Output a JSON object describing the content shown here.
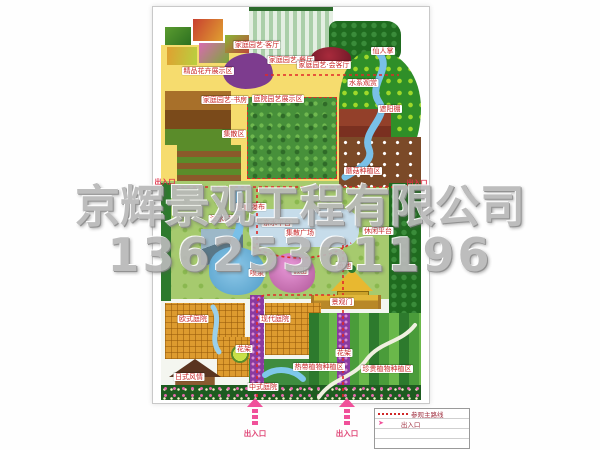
{
  "watermark": {
    "company": "京辉景观工程有限公司",
    "phone": "13625361196"
  },
  "colors": {
    "route_red": "#e02828",
    "entrance_pink": "#f0509a",
    "label_red": "#c82828",
    "watermark_gray": "#b9b9b9",
    "base_yellow": "#f6dc6e"
  },
  "map_labels": [
    {
      "text": "精品花卉展示区",
      "x": 55,
      "y": 64,
      "kind": "box"
    },
    {
      "text": "家庭园艺·客厅",
      "x": 104,
      "y": 38,
      "kind": "box"
    },
    {
      "text": "家庭园艺·餐厅",
      "x": 138,
      "y": 53,
      "kind": "box"
    },
    {
      "text": "家庭园艺·会客厅",
      "x": 171,
      "y": 58,
      "kind": "box"
    },
    {
      "text": "家庭园艺·书房",
      "x": 72,
      "y": 93,
      "kind": "box"
    },
    {
      "text": "庭院园艺展示区",
      "x": 125,
      "y": 92,
      "kind": "box"
    },
    {
      "text": "集散区",
      "x": 81,
      "y": 127,
      "kind": "box"
    },
    {
      "text": "仙人掌",
      "x": 230,
      "y": 44,
      "kind": "box"
    },
    {
      "text": "水系观赏",
      "x": 210,
      "y": 76,
      "kind": "box"
    },
    {
      "text": "遮阳棚",
      "x": 237,
      "y": 102,
      "kind": "box"
    },
    {
      "text": "蘑菇种植区",
      "x": 210,
      "y": 164,
      "kind": "box"
    },
    {
      "text": "出入口",
      "x": 12,
      "y": 175,
      "kind": "plain"
    },
    {
      "text": "出入口",
      "x": 264,
      "y": 176,
      "kind": "plain"
    },
    {
      "text": "滨水栈道",
      "x": 71,
      "y": 212,
      "kind": "box"
    },
    {
      "text": "假山瀑布",
      "x": 98,
      "y": 200,
      "kind": "box"
    },
    {
      "text": "亲水平台",
      "x": 124,
      "y": 216,
      "kind": "box"
    },
    {
      "text": "集散广场",
      "x": 147,
      "y": 226,
      "kind": "box"
    },
    {
      "text": "休闲平台",
      "x": 225,
      "y": 224,
      "kind": "box"
    },
    {
      "text": "喷泉",
      "x": 104,
      "y": 266,
      "kind": "box"
    },
    {
      "text": "假山",
      "x": 147,
      "y": 264,
      "kind": "box"
    },
    {
      "text": "鱼池",
      "x": 191,
      "y": 259,
      "kind": "box"
    },
    {
      "text": "景观门",
      "x": 189,
      "y": 295,
      "kind": "box"
    },
    {
      "text": "欧式庭院",
      "x": 40,
      "y": 312,
      "kind": "box"
    },
    {
      "text": "现代庭院",
      "x": 122,
      "y": 312,
      "kind": "box"
    },
    {
      "text": "花架",
      "x": 91,
      "y": 342,
      "kind": "box"
    },
    {
      "text": "花架",
      "x": 191,
      "y": 346,
      "kind": "box"
    },
    {
      "text": "日式风情",
      "x": 36,
      "y": 370,
      "kind": "box"
    },
    {
      "text": "中式庭院",
      "x": 110,
      "y": 380,
      "kind": "box"
    },
    {
      "text": "热带植物种植区",
      "x": 166,
      "y": 360,
      "kind": "box"
    },
    {
      "text": "珍贵植物种植区",
      "x": 234,
      "y": 362,
      "kind": "box"
    }
  ],
  "entrances": {
    "bottom": [
      {
        "label": "出入口"
      },
      {
        "label": "出入口"
      }
    ]
  },
  "legend": {
    "rows": [
      {
        "symbol": "dotted-route",
        "label": "参观主路线"
      },
      {
        "symbol": "entrance-arrow",
        "label": "出入口"
      }
    ]
  }
}
